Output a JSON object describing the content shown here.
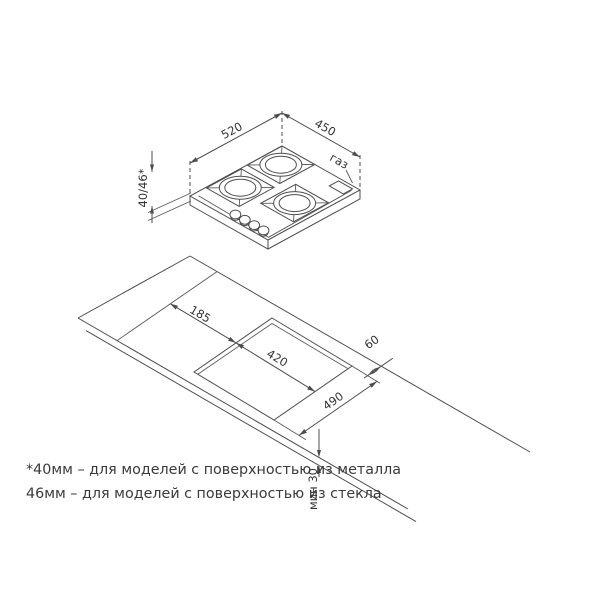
{
  "top_view": {
    "width_label": "520",
    "depth_label": "450",
    "gas_label": "газ",
    "height_label": "40/46*"
  },
  "installation_view": {
    "side_offset_label": "185",
    "cutout_depth_label": "420",
    "cutout_width_label": "490",
    "rear_clearance_label": "60",
    "min_thickness_label": "мин 30"
  },
  "footnote": {
    "line1": "*40мм – для моделей с поверхностью из металла",
    "line2": "46мм – для моделей с поверхностью из стекла"
  },
  "colors": {
    "line": "#4d4d4d",
    "text": "#3a3a3a",
    "background": "#ffffff"
  }
}
